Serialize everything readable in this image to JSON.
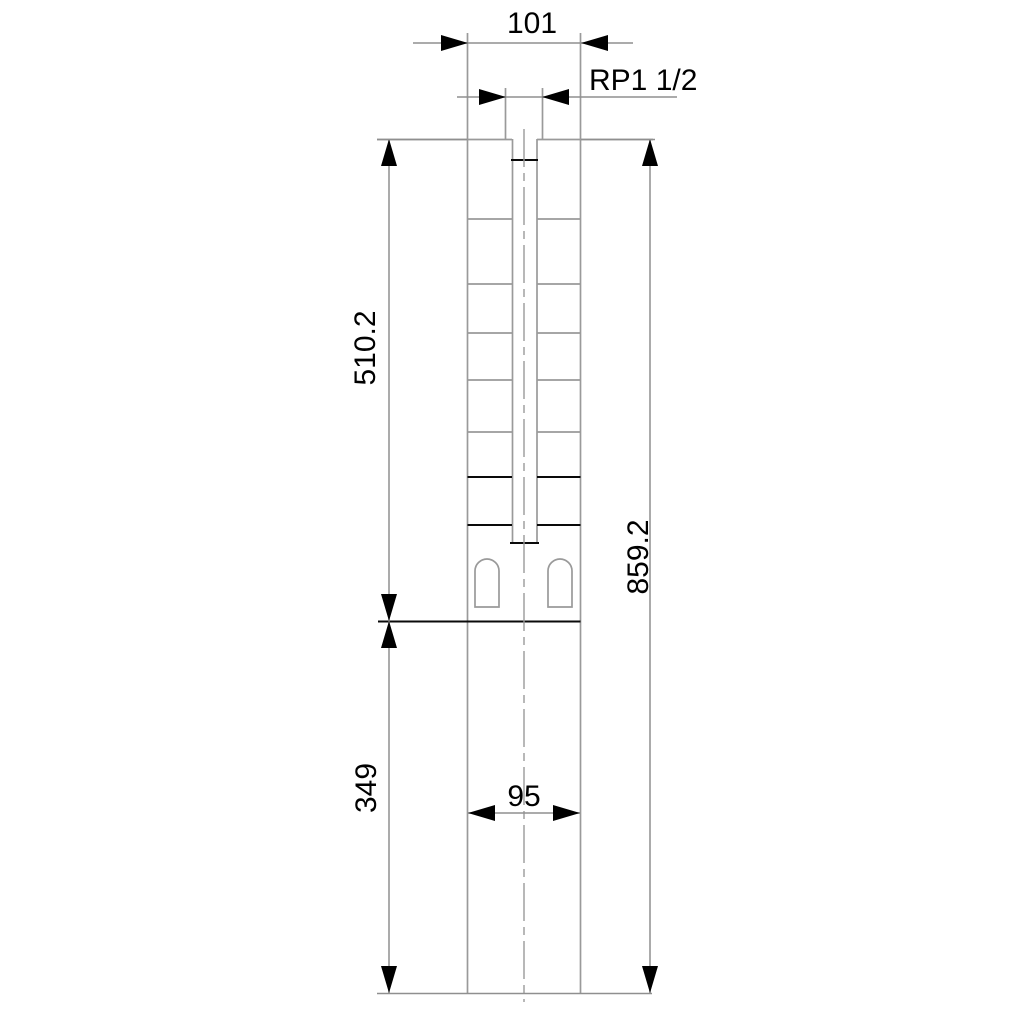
{
  "labels": {
    "width_top": "101",
    "thread": "RP1 1/2",
    "height_upper": "510.2",
    "height_total": "859.2",
    "height_lower": "349",
    "width_bottom": "95"
  },
  "colors": {
    "background": "#ffffff",
    "object_line": "#9a9a9a",
    "strong_line": "#0a0a0a",
    "dimension_line": "#8f8f8f",
    "text": "#000000"
  }
}
